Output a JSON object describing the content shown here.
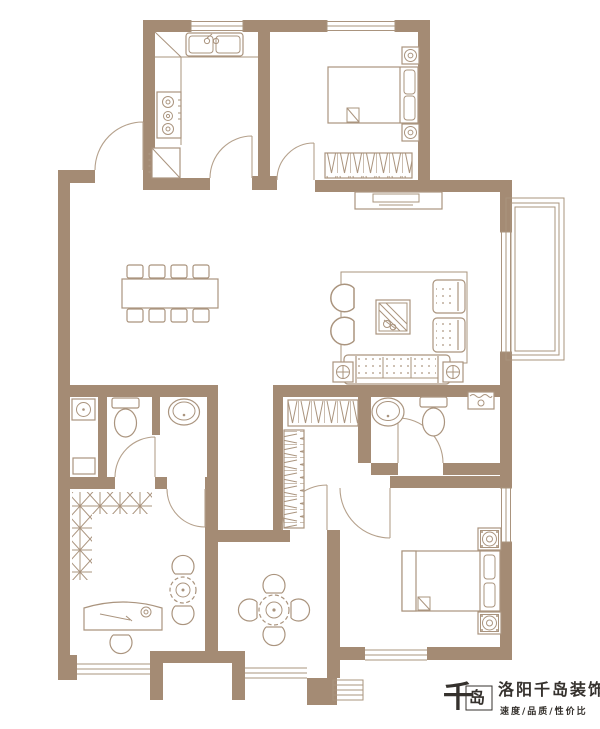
{
  "branding": {
    "logo_mark": "千",
    "logo_mark_2": "岛",
    "company_name": "洛阳千岛装饰",
    "tagline": "速度/品质/性价比"
  },
  "colors": {
    "wall": "#a48b74",
    "line": "#aa947e",
    "line2": "#b5a18c",
    "bg": "#ffffff",
    "logo": "#35312d"
  },
  "plan": {
    "type": "apartment-floor-plan",
    "rooms": [
      {
        "name": "kitchen",
        "furniture": [
          "corner-counter",
          "double-sink",
          "gas-stove",
          "refrigerator"
        ]
      },
      {
        "name": "bedroom-top",
        "furniture": [
          "double-bed",
          "nightstand-with-lamp",
          "nightstand-with-lamp",
          "wardrobe"
        ]
      },
      {
        "name": "dining-area",
        "furniture": [
          "dining-table",
          "chair-x8"
        ]
      },
      {
        "name": "living-room",
        "furniture": [
          "armchair",
          "armchair",
          "coffee-table-with-plant",
          "loveseat",
          "loveseat",
          "three-seat-sofa",
          "side-table",
          "side-table",
          "tv-cabinet",
          "rug"
        ]
      },
      {
        "name": "bathroom-main",
        "furniture": [
          "laundry-basin",
          "toilet",
          "oval-washbasin",
          "shelf"
        ]
      },
      {
        "name": "cloakroom",
        "furniture": [
          "l-shaped-wardrobe"
        ]
      },
      {
        "name": "bathroom-2",
        "furniture": [
          "oval-washbasin",
          "toilet",
          "corner-basin"
        ]
      },
      {
        "name": "study",
        "furniture": [
          "l-shaped-shelving",
          "desk",
          "chair",
          "tea-table",
          "chair",
          "chair"
        ]
      },
      {
        "name": "tea-room",
        "furniture": [
          "round-table",
          "chair",
          "chair",
          "chair",
          "chair"
        ]
      },
      {
        "name": "master-bedroom",
        "furniture": [
          "double-bed",
          "nightstand",
          "nightstand"
        ]
      },
      {
        "name": "balcony",
        "furniture": [
          "window-wall"
        ]
      },
      {
        "name": "entry",
        "furniture": [
          "entry-door"
        ]
      },
      {
        "name": "exterior-stairs",
        "furniture": [
          "steps"
        ]
      }
    ],
    "windows": [
      "kitchen-top",
      "bedroom-top",
      "living-right",
      "master-right",
      "study-bottom",
      "tea-room-bottom",
      "master-bottom-bay"
    ],
    "doors": [
      "entry",
      "kitchen",
      "bedroom-top",
      "toilet-compartment",
      "study",
      "bathroom-2",
      "master-bedroom",
      "tea-room"
    ]
  }
}
